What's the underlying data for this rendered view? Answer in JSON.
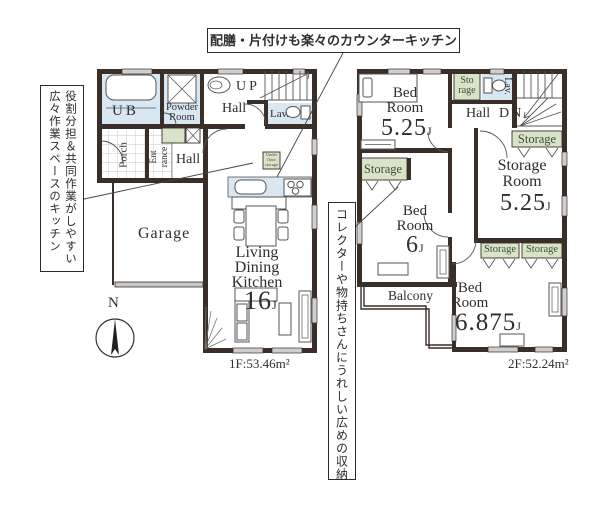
{
  "palette": {
    "wall": "#3a2e29",
    "blue": "#d9e7f2",
    "green": "#d8e4c8",
    "line": "#555555",
    "window": "#cfcfcf"
  },
  "callouts": {
    "counter_kitchen": "配膳・片付けも楽々のカウンターキッチン",
    "kitchen_space": [
      "役割分担＆共同作業がしやすい",
      "広々作業スペースのキッチン"
    ],
    "storage_note": "コレクターや物持ちさんにうれしい広めの収納"
  },
  "compass": {
    "label": "N"
  },
  "floor1": {
    "area": "1F:53.46m²",
    "ub": "UB",
    "powder_room": [
      "Powder",
      "Room"
    ],
    "hall_upper": "Hall",
    "up": "UP",
    "lav": "Lav.",
    "porch": "Porch",
    "entrance": [
      "Ent",
      "rance"
    ],
    "hall_lower": "Hall",
    "garage": "Garage",
    "ldk": [
      "Living",
      "Dining",
      "Kitchen"
    ],
    "ldk_size": "16",
    "ldk_size_unit": "J",
    "underfloor_storage": [
      "Under",
      "floor",
      "storage"
    ]
  },
  "floor2": {
    "area": "2F:52.24m²",
    "bedroom1": [
      "Bed",
      "Room"
    ],
    "bedroom1_size": "5.25",
    "storage_small": [
      "Sto",
      "rage"
    ],
    "lav": "Lav.",
    "hall": "Hall",
    "dn": "DN",
    "storage_label": "Storage",
    "storage_room": [
      "Storage",
      "Room"
    ],
    "storage_room_size": "5.25",
    "bedroom2": [
      "Bed",
      "Room"
    ],
    "bedroom2_size": "6",
    "balcony": "Balcony",
    "bedroom3": [
      "Bed",
      "Room"
    ],
    "bedroom3_size": "6.875",
    "size_unit": "J"
  }
}
